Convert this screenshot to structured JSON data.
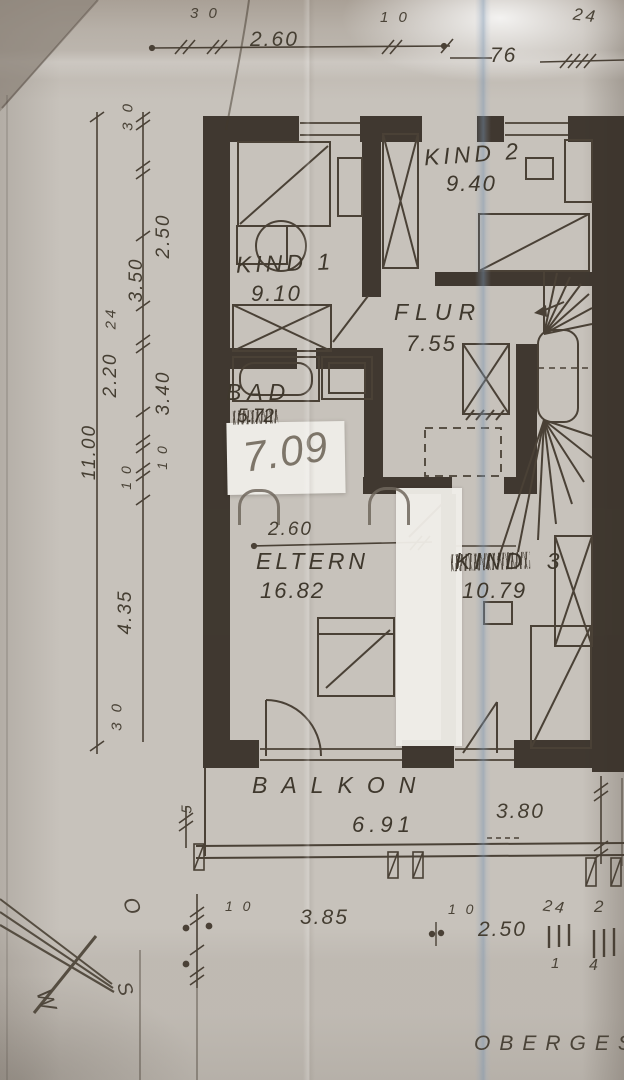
{
  "colors": {
    "paper": "#c7c2bb",
    "ink": "#4a4136",
    "wall": "#362e26",
    "pencil": "#766e62",
    "fold_blue": "#9fb4c6"
  },
  "rooms": {
    "kind2": {
      "name": "KIND 2",
      "area": "9.40"
    },
    "kind1": {
      "name": "KIND 1",
      "area": "9.10"
    },
    "flur": {
      "name": "FLUR",
      "area": "7.55"
    },
    "bad": {
      "name": "BAD",
      "area_crossed": "5.72",
      "area_handwritten": "7.09"
    },
    "eltern": {
      "name": "ELTERN",
      "area": "16.82",
      "door_width": "2.60"
    },
    "kind3": {
      "name_scribbled": "KIND",
      "name_number": "3",
      "area": "10.79"
    },
    "balkon": {
      "name": "BALKON",
      "area": "6.91"
    }
  },
  "dims": {
    "top": {
      "t30": "3 0",
      "t260": "2.60",
      "t10": "1 0",
      "t76": "76",
      "t24": "24"
    },
    "left": {
      "l30": "3 0",
      "l250": "2.50",
      "l350": "3.50",
      "l24": "24",
      "l220": "2.20",
      "l340": "3.40",
      "l1100": "11.00",
      "l10a": "1 0",
      "l10b": "1 0",
      "l435": "4.35",
      "l30b": "3 0"
    },
    "right": {
      "r380": "3.80"
    },
    "bottom": {
      "b5": "5",
      "b10a": "1 0",
      "b385": "3.85",
      "b10b": "1 0",
      "b250": "2.50",
      "b24": "24",
      "b2": "2",
      "b1": "1",
      "b4": "4"
    }
  },
  "compass": {
    "o": "O",
    "w": "W",
    "s": "S"
  },
  "footer": {
    "title": "OBERGES"
  }
}
